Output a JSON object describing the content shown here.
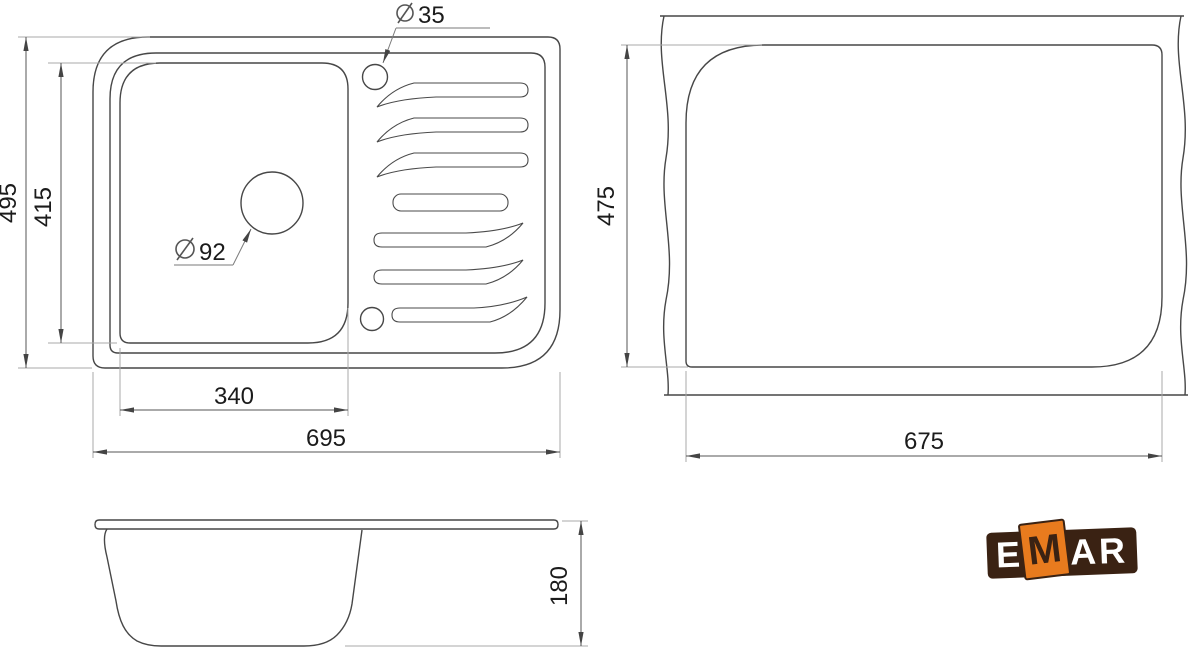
{
  "diagram": {
    "kind": "sink-technical-drawing",
    "views": {
      "top": {
        "name": "sink top view",
        "width_label": "495",
        "bowl_width_label": "415",
        "bowl_length_label": "340",
        "length_label": "695",
        "faucet_hole_diameter": "35",
        "drain_hole_diameter": "92"
      },
      "cutout": {
        "name": "countertop cutout view",
        "width_label": "475",
        "length_label": "675"
      },
      "side": {
        "name": "sink side view",
        "height_label": "180"
      }
    },
    "icons": {
      "diameter_symbol": "⌀"
    },
    "logo": {
      "brand": "EMAR",
      "e": "E",
      "m": "M",
      "a": "A",
      "r": "R",
      "colors": {
        "brown": "#3A2213",
        "orange": "#E87B1E",
        "letters": "#FFFFFF"
      }
    },
    "colors": {
      "outline": "#474747",
      "dimension_lines": "#555555",
      "extension_lines": "#A8A8A8",
      "text": "#1B1B1B",
      "background": "#FFFFFF"
    }
  }
}
